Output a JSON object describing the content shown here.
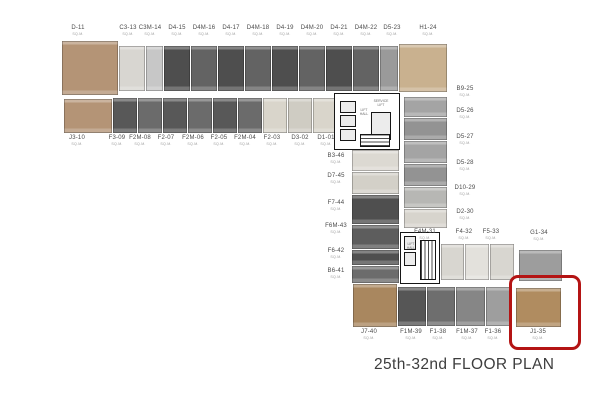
{
  "title": "25th-32nd FLOOR PLAN",
  "plan": {
    "area_label": "SQ.M.",
    "highlight": {
      "x": 509,
      "y": 275,
      "w": 66,
      "h": 69,
      "color": "#b41414"
    },
    "blocks": [
      {
        "id": "D-11",
        "x": 62,
        "y": 41,
        "w": 56,
        "h": 54,
        "c": "#b49476"
      },
      {
        "id": "J3-10",
        "x": 64,
        "y": 99,
        "w": 48,
        "h": 34,
        "c": "#b49476"
      },
      {
        "id": "C3-13",
        "x": 119,
        "y": 46,
        "w": 26,
        "h": 45,
        "c": "#d8d6d1"
      },
      {
        "id": "C3M-14",
        "x": 146,
        "y": 46,
        "w": 17,
        "h": 45,
        "c": "#c7c7c7"
      },
      {
        "id": "D4-15",
        "x": 164,
        "y": 46,
        "w": 26,
        "h": 45,
        "c": "#4e4e4e"
      },
      {
        "id": "D4M-16",
        "x": 191,
        "y": 46,
        "w": 26,
        "h": 45,
        "c": "#636363"
      },
      {
        "id": "D4-17",
        "x": 218,
        "y": 46,
        "w": 26,
        "h": 45,
        "c": "#4e4e4e"
      },
      {
        "id": "D4M-18",
        "x": 245,
        "y": 46,
        "w": 26,
        "h": 45,
        "c": "#636363"
      },
      {
        "id": "D4-19",
        "x": 272,
        "y": 46,
        "w": 26,
        "h": 45,
        "c": "#4e4e4e"
      },
      {
        "id": "D4M-20",
        "x": 299,
        "y": 46,
        "w": 26,
        "h": 45,
        "c": "#636363"
      },
      {
        "id": "D4-21",
        "x": 326,
        "y": 46,
        "w": 26,
        "h": 45,
        "c": "#4e4e4e"
      },
      {
        "id": "D4M-22",
        "x": 353,
        "y": 46,
        "w": 26,
        "h": 45,
        "c": "#636363"
      },
      {
        "id": "D5-23",
        "x": 380,
        "y": 46,
        "w": 18,
        "h": 45,
        "c": "#9a9a9a"
      },
      {
        "id": "H1-24",
        "x": 399,
        "y": 44,
        "w": 48,
        "h": 48,
        "c": "#c9b18f"
      },
      {
        "id": "F3-09",
        "x": 113,
        "y": 98,
        "w": 24,
        "h": 35,
        "c": "#585858"
      },
      {
        "id": "F2M-08",
        "x": 138,
        "y": 98,
        "w": 24,
        "h": 35,
        "c": "#6b6b6b"
      },
      {
        "id": "F2-07",
        "x": 163,
        "y": 98,
        "w": 24,
        "h": 35,
        "c": "#585858"
      },
      {
        "id": "F2M-06",
        "x": 188,
        "y": 98,
        "w": 24,
        "h": 35,
        "c": "#6b6b6b"
      },
      {
        "id": "F2-05",
        "x": 213,
        "y": 98,
        "w": 24,
        "h": 35,
        "c": "#585858"
      },
      {
        "id": "F2M-04",
        "x": 238,
        "y": 98,
        "w": 24,
        "h": 35,
        "c": "#6b6b6b"
      },
      {
        "id": "F2-03",
        "x": 263,
        "y": 98,
        "w": 24,
        "h": 35,
        "c": "#d9d5cb"
      },
      {
        "id": "D3-02",
        "x": 288,
        "y": 98,
        "w": 24,
        "h": 35,
        "c": "#cfccc3"
      },
      {
        "id": "D1-01",
        "x": 313,
        "y": 98,
        "w": 26,
        "h": 35,
        "c": "#d9d5cb"
      },
      {
        "id": "B9-25",
        "x": 404,
        "y": 97,
        "w": 43,
        "h": 20,
        "c": "#a4a4a4"
      },
      {
        "id": "D5-26",
        "x": 404,
        "y": 118,
        "w": 43,
        "h": 22,
        "c": "#939393"
      },
      {
        "id": "D5-27",
        "x": 404,
        "y": 141,
        "w": 43,
        "h": 22,
        "c": "#a4a4a4"
      },
      {
        "id": "D5-28",
        "x": 404,
        "y": 164,
        "w": 43,
        "h": 22,
        "c": "#939393"
      },
      {
        "id": "D10-29",
        "x": 404,
        "y": 187,
        "w": 43,
        "h": 21,
        "c": "#b7b7b4"
      },
      {
        "id": "D2-30",
        "x": 404,
        "y": 209,
        "w": 43,
        "h": 19,
        "c": "#d7d4cd"
      },
      {
        "id": "B3-46",
        "x": 352,
        "y": 150,
        "w": 47,
        "h": 21,
        "c": "#dcd9d2"
      },
      {
        "id": "D7-45",
        "x": 352,
        "y": 172,
        "w": 47,
        "h": 22,
        "c": "#d3d0c8"
      },
      {
        "id": "F7-44",
        "x": 352,
        "y": 195,
        "w": 47,
        "h": 29,
        "c": "#4f4f4f"
      },
      {
        "id": "F6M-43",
        "x": 352,
        "y": 225,
        "w": 47,
        "h": 24,
        "c": "#5d5d5d"
      },
      {
        "id": "F6-42",
        "x": 352,
        "y": 250,
        "w": 47,
        "h": 15,
        "c": "#4f4f4f"
      },
      {
        "id": "B6-41",
        "x": 352,
        "y": 266,
        "w": 47,
        "h": 17,
        "c": "#6c6c6c"
      },
      {
        "id": "F4M-31",
        "x": 441,
        "y": 244,
        "w": 23,
        "h": 36,
        "c": "#d8d6d0"
      },
      {
        "id": "F4-32",
        "x": 465,
        "y": 244,
        "w": 24,
        "h": 36,
        "c": "#e3e1dc"
      },
      {
        "id": "F5-33",
        "x": 490,
        "y": 244,
        "w": 24,
        "h": 36,
        "c": "#d8d6d0"
      },
      {
        "id": "G1-34",
        "x": 519,
        "y": 250,
        "w": 43,
        "h": 31,
        "c": "#9d9d9d"
      },
      {
        "id": "J7-40",
        "x": 353,
        "y": 284,
        "w": 44,
        "h": 43,
        "c": "#a9875f"
      },
      {
        "id": "F1M-39",
        "x": 398,
        "y": 287,
        "w": 28,
        "h": 39,
        "c": "#565656"
      },
      {
        "id": "F1-38",
        "x": 427,
        "y": 287,
        "w": 28,
        "h": 39,
        "c": "#6e6e6e"
      },
      {
        "id": "F1M-37",
        "x": 456,
        "y": 287,
        "w": 29,
        "h": 39,
        "c": "#868686"
      },
      {
        "id": "F1-36",
        "x": 486,
        "y": 287,
        "w": 26,
        "h": 39,
        "c": "#9e9e9e"
      },
      {
        "id": "J1-35",
        "x": 516,
        "y": 288,
        "w": 45,
        "h": 39,
        "c": "#b08c60"
      }
    ],
    "cores": [
      {
        "id": "core-1",
        "x": 334,
        "y": 93,
        "w": 66,
        "h": 57
      },
      {
        "id": "core-2",
        "x": 400,
        "y": 232,
        "w": 40,
        "h": 52
      }
    ],
    "shafts": [
      {
        "id": "lift-1",
        "x": 340,
        "y": 101,
        "w": 16,
        "h": 12
      },
      {
        "id": "lift-2",
        "x": 340,
        "y": 115,
        "w": 16,
        "h": 12
      },
      {
        "id": "lift-3",
        "x": 340,
        "y": 129,
        "w": 16,
        "h": 12
      },
      {
        "id": "service-lift-shaft",
        "x": 371,
        "y": 112,
        "w": 20,
        "h": 28
      },
      {
        "id": "lift-4",
        "x": 404,
        "y": 236,
        "w": 12,
        "h": 14
      },
      {
        "id": "lift-5",
        "x": 404,
        "y": 252,
        "w": 12,
        "h": 14
      }
    ],
    "stairs": [
      {
        "id": "stair-1",
        "x": 360,
        "y": 134,
        "w": 30,
        "h": 13,
        "horiz": true
      },
      {
        "id": "stair-2",
        "x": 420,
        "y": 240,
        "w": 16,
        "h": 40,
        "horiz": false
      }
    ],
    "core_labels": [
      {
        "id": "lift-hall-1",
        "text": "LIFT HALL",
        "x": 357,
        "y": 108,
        "w": 14
      },
      {
        "id": "service-lift",
        "text": "SERVICE LIFT",
        "x": 371,
        "y": 99,
        "w": 20
      },
      {
        "id": "lift-hall-2",
        "text": "LIFT HALL",
        "x": 404,
        "y": 242,
        "w": 14
      }
    ],
    "labels": [
      {
        "id": "D-11",
        "x": 78,
        "y": 25
      },
      {
        "id": "C3-13",
        "x": 128,
        "y": 25
      },
      {
        "id": "C3M-14",
        "x": 150,
        "y": 25
      },
      {
        "id": "D4-15",
        "x": 177,
        "y": 25
      },
      {
        "id": "D4M-16",
        "x": 204,
        "y": 25
      },
      {
        "id": "D4-17",
        "x": 231,
        "y": 25
      },
      {
        "id": "D4M-18",
        "x": 258,
        "y": 25
      },
      {
        "id": "D4-19",
        "x": 285,
        "y": 25
      },
      {
        "id": "D4M-20",
        "x": 312,
        "y": 25
      },
      {
        "id": "D4-21",
        "x": 339,
        "y": 25
      },
      {
        "id": "D4M-22",
        "x": 366,
        "y": 25
      },
      {
        "id": "D5-23",
        "x": 392,
        "y": 25
      },
      {
        "id": "H1-24",
        "x": 428,
        "y": 25
      },
      {
        "id": "J3-10",
        "x": 77,
        "y": 135
      },
      {
        "id": "F3-09",
        "x": 117,
        "y": 135
      },
      {
        "id": "F2M-08",
        "x": 140,
        "y": 135
      },
      {
        "id": "F2-07",
        "x": 166,
        "y": 135
      },
      {
        "id": "F2M-06",
        "x": 193,
        "y": 135
      },
      {
        "id": "F2-05",
        "x": 219,
        "y": 135
      },
      {
        "id": "F2M-04",
        "x": 245,
        "y": 135
      },
      {
        "id": "F2-03",
        "x": 272,
        "y": 135
      },
      {
        "id": "D3-02",
        "x": 300,
        "y": 135
      },
      {
        "id": "D1-01",
        "x": 326,
        "y": 135
      },
      {
        "id": "B9-25",
        "x": 465,
        "y": 86
      },
      {
        "id": "D5-26",
        "x": 465,
        "y": 108
      },
      {
        "id": "D5-27",
        "x": 465,
        "y": 134
      },
      {
        "id": "D5-28",
        "x": 465,
        "y": 160
      },
      {
        "id": "D10-29",
        "x": 465,
        "y": 185
      },
      {
        "id": "D2-30",
        "x": 465,
        "y": 209
      },
      {
        "id": "B3-46",
        "x": 336,
        "y": 153
      },
      {
        "id": "D7-45",
        "x": 336,
        "y": 173
      },
      {
        "id": "F7-44",
        "x": 336,
        "y": 200
      },
      {
        "id": "F6M-43",
        "x": 336,
        "y": 223
      },
      {
        "id": "F6-42",
        "x": 336,
        "y": 248
      },
      {
        "id": "B6-41",
        "x": 336,
        "y": 268
      },
      {
        "id": "F4M-31",
        "x": 425,
        "y": 229
      },
      {
        "id": "F4-32",
        "x": 464,
        "y": 229
      },
      {
        "id": "F5-33",
        "x": 491,
        "y": 229
      },
      {
        "id": "G1-34",
        "x": 539,
        "y": 230
      },
      {
        "id": "J7-40",
        "x": 369,
        "y": 329
      },
      {
        "id": "F1M-39",
        "x": 411,
        "y": 329
      },
      {
        "id": "F1-38",
        "x": 438,
        "y": 329
      },
      {
        "id": "F1M-37",
        "x": 467,
        "y": 329
      },
      {
        "id": "F1-36",
        "x": 493,
        "y": 329
      },
      {
        "id": "J1-35",
        "x": 538,
        "y": 329
      }
    ]
  }
}
